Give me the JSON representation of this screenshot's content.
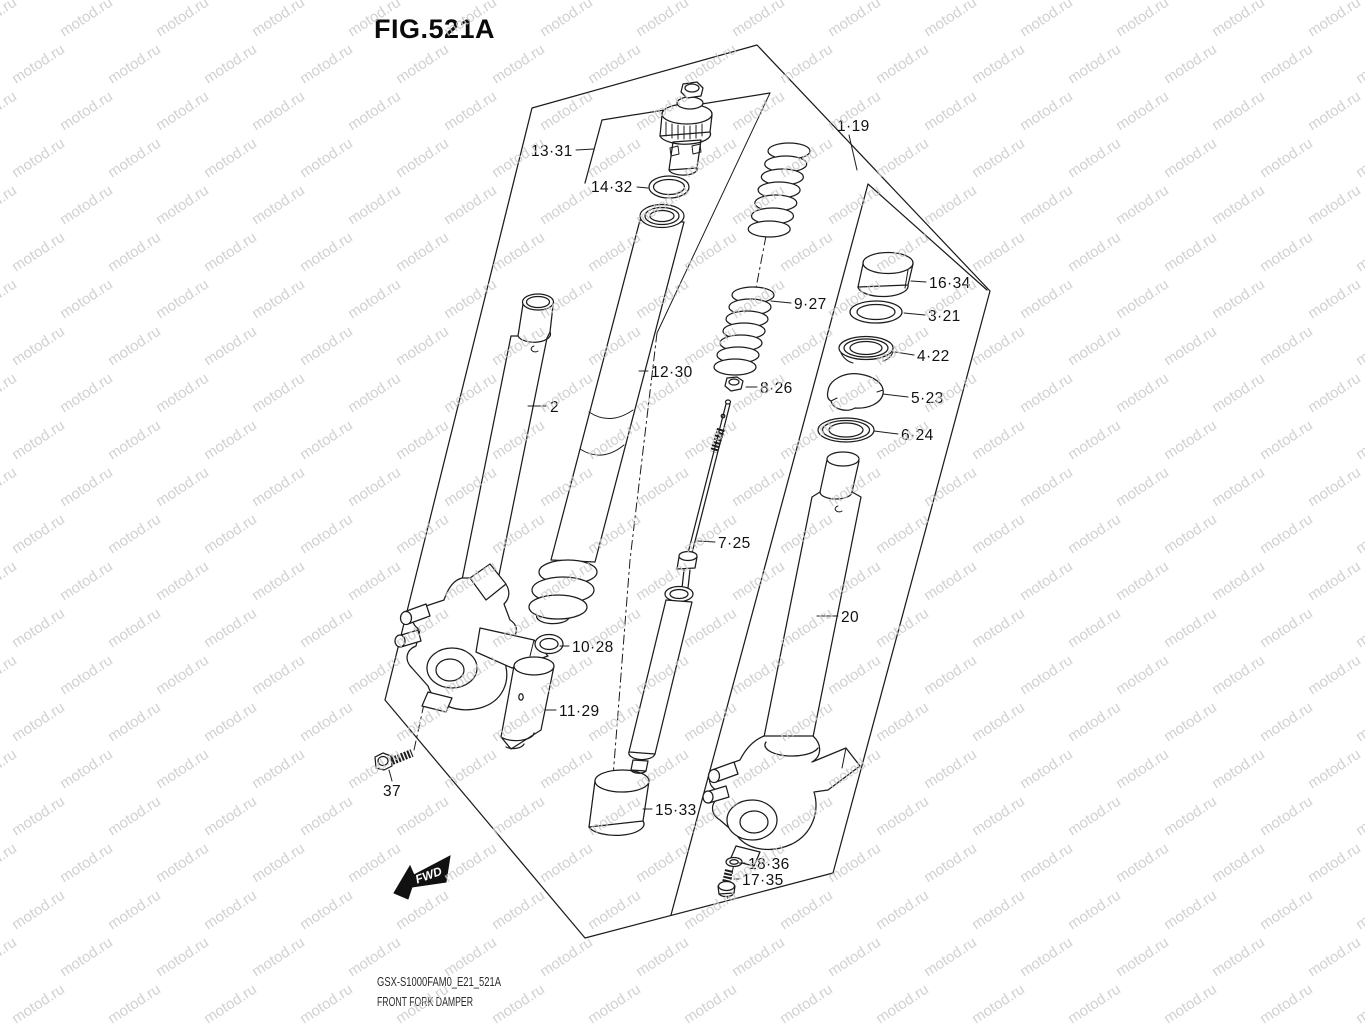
{
  "title": "FIG.521A",
  "watermark": {
    "text": "motod.ru",
    "color": "#c9c9c9"
  },
  "fwd": {
    "label": "FWD"
  },
  "footer": {
    "code": "GSX-S1000FAM0_E21_521A",
    "name": "FRONT FORK DAMPER"
  },
  "diagram": {
    "ink": "#1c1c1c",
    "background": "#ffffff"
  },
  "part_labels": [
    {
      "id": "13-31",
      "text": "13·31",
      "x": 531,
      "y": 156,
      "leader": [
        576,
        150,
        594,
        149
      ]
    },
    {
      "id": "14-32",
      "text": "14·32",
      "x": 591,
      "y": 192,
      "leader": [
        637,
        187,
        648,
        188
      ]
    },
    {
      "id": "1-19",
      "text": "1·19",
      "x": 837,
      "y": 131,
      "leader": [
        849,
        135,
        857,
        170
      ]
    },
    {
      "id": "2",
      "text": "2",
      "x": 550,
      "y": 412,
      "leader": [
        546,
        406,
        528,
        406
      ]
    },
    {
      "id": "12-30",
      "text": "12·30",
      "x": 651,
      "y": 377,
      "leader": [
        648,
        371,
        639,
        371
      ]
    },
    {
      "id": "9-27",
      "text": "9·27",
      "x": 794,
      "y": 309,
      "leader": [
        791,
        303,
        771,
        301
      ]
    },
    {
      "id": "8-26",
      "text": "8·26",
      "x": 760,
      "y": 393,
      "leader": [
        757,
        387,
        746,
        387
      ]
    },
    {
      "id": "16-34",
      "text": "16·34",
      "x": 929,
      "y": 288,
      "leader": [
        926,
        282,
        911,
        281
      ]
    },
    {
      "id": "3-21",
      "text": "3·21",
      "x": 928,
      "y": 321,
      "leader": [
        925,
        315,
        904,
        313
      ]
    },
    {
      "id": "4-22",
      "text": "4·22",
      "x": 917,
      "y": 361,
      "leader": [
        914,
        355,
        895,
        352
      ]
    },
    {
      "id": "5-23",
      "text": "5·23",
      "x": 911,
      "y": 403,
      "leader": [
        908,
        397,
        883,
        394
      ]
    },
    {
      "id": "6-24",
      "text": "6·24",
      "x": 901,
      "y": 440,
      "leader": [
        898,
        434,
        874,
        431
      ]
    },
    {
      "id": "7-25",
      "text": "7·25",
      "x": 718,
      "y": 548,
      "leader": [
        715,
        542,
        698,
        541
      ]
    },
    {
      "id": "10-28",
      "text": "10·28",
      "x": 572,
      "y": 652,
      "leader": [
        569,
        646,
        560,
        646
      ]
    },
    {
      "id": "11-29",
      "text": "11·29",
      "x": 559,
      "y": 716,
      "leader": [
        556,
        710,
        544,
        710
      ]
    },
    {
      "id": "15-33",
      "text": "15·33",
      "x": 655,
      "y": 815,
      "leader": [
        652,
        809,
        643,
        809
      ]
    },
    {
      "id": "20",
      "text": "20",
      "x": 841,
      "y": 622,
      "leader": [
        838,
        616,
        817,
        616
      ]
    },
    {
      "id": "18-36",
      "text": "18·36",
      "x": 748,
      "y": 869,
      "leader": [
        745,
        863,
        739,
        863
      ]
    },
    {
      "id": "17-35",
      "text": "17·35",
      "x": 742,
      "y": 885,
      "leader": [
        739,
        879,
        734,
        879
      ]
    },
    {
      "id": "37",
      "text": "37",
      "x": 383,
      "y": 796,
      "leader": [
        392,
        781,
        389,
        770
      ]
    }
  ]
}
